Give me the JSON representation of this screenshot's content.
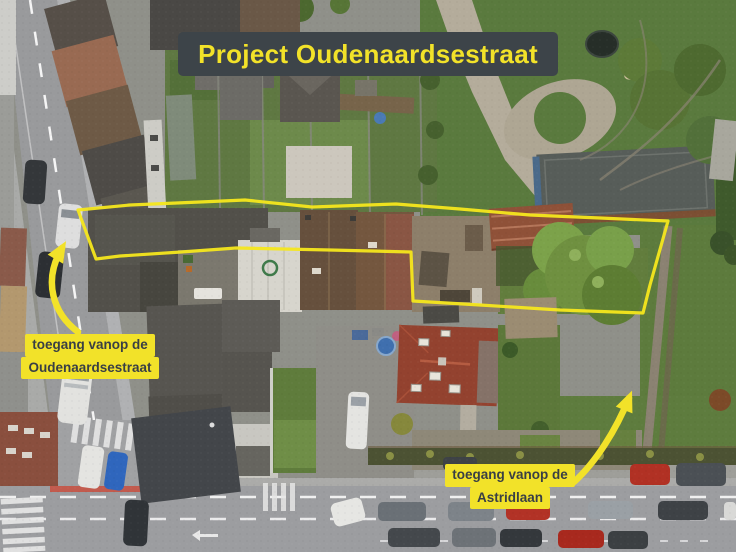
{
  "annotations": {
    "title": {
      "text": "Project Oudenaardsestraat",
      "bg": "#3d4449",
      "color": "#f2e229"
    },
    "boundary": {
      "color": "#f6e71c"
    },
    "arrow_color": "#f2e229",
    "labels": [
      {
        "id": "access-oudenaardsestraat",
        "lines": [
          "toegang vanop de",
          "Oudenaardsestraat"
        ]
      },
      {
        "id": "access-astridlaan",
        "lines": [
          "toegang vanop de",
          "Astridlaan"
        ]
      }
    ]
  },
  "palette": {
    "label_bg": "#f2e229",
    "label_text": "#393f45",
    "banner_bg": "#3d4449",
    "banner_text": "#f2e229",
    "grass": "#5d7a3f",
    "asphalt": "#9a9b9d",
    "roof_dark": "#514f4a",
    "roof_red": "#93422f",
    "barn_roof_rust": "#8f5138"
  }
}
